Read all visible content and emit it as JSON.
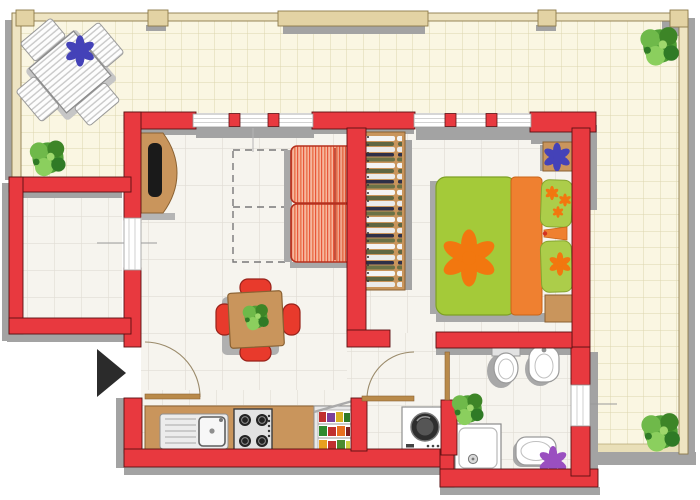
{
  "title": "apartment-floor-plan",
  "colors": {
    "wall": "#e8393f",
    "wall_outline": "#5a1012",
    "terrace_floor": "#faf6e2",
    "terrace_grid": "#dcd5ae",
    "interior_floor": "#f6f4ee",
    "interior_grid": "#e0dcd4",
    "shadow": "#a3a3a3",
    "wood": "#c9955c",
    "wood_edge": "#8a6132",
    "railing": "#eee4c2",
    "bed_green": "#a4ca39",
    "bed_orange": "#ef8030",
    "pillow_green": "#accd4a",
    "flower_orange": "#f2770f",
    "flower_blue": "#4442b8",
    "flower_purple": "#9a4fc0",
    "plant_green": "#4f9e35",
    "chair_red": "#e83a2c",
    "sofa_border": "#b5311f",
    "arrow_black": "#2b2b2b",
    "fixture_white": "#ffffff",
    "fixture_outline": "#9a9a9a"
  },
  "plan": {
    "outdoor": {
      "name": "terrace",
      "furniture": [
        "outdoor-table-with-chairs",
        "plant-top-right",
        "plant-left",
        "plant-bottom-right",
        "railing",
        "pergola-beam"
      ]
    },
    "rooms": [
      {
        "name": "living-room",
        "furniture": [
          "striped-sofa",
          "tv-cabinet",
          "dashed-rug-outline",
          "window-top",
          "window-left"
        ]
      },
      {
        "name": "dining-area",
        "furniture": [
          "square-table",
          "four-red-chairs",
          "table-plant"
        ]
      },
      {
        "name": "kitchen",
        "furniture": [
          "counter",
          "sink",
          "gas-stove",
          "open-fridge",
          "washing-machine",
          "entrance-door"
        ]
      },
      {
        "name": "bedroom",
        "furniture": [
          "double-bed",
          "wardrobe-with-clothes",
          "nightstand-top",
          "nightstand-bottom",
          "bed-lamp",
          "window-top"
        ]
      },
      {
        "name": "bathroom",
        "furniture": [
          "toilet",
          "bidet",
          "shower-tray",
          "washbasin",
          "plant",
          "window-right",
          "door"
        ]
      },
      {
        "name": "balcony",
        "furniture": [
          "window-to-living-room"
        ]
      }
    ],
    "entrance_marker": "black-arrow-pointing-right"
  }
}
